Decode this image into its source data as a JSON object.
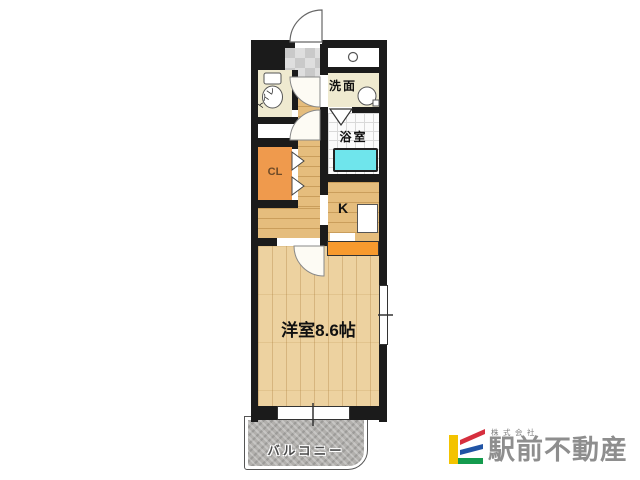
{
  "floorplan": {
    "labels": {
      "toilet": "トイレ",
      "washroom": "洗面",
      "bathroom": "浴室",
      "closet": "CL",
      "kitchen": "K",
      "main_room": "洋室8.6帖",
      "balcony": "バルコニー"
    },
    "colors": {
      "wall": "#1b1b1b",
      "hall_floor": "#e5bd7d",
      "room_floor": "#edd2a0",
      "cream_floor": "#efead0",
      "genkan_tile": "#d3d3d3",
      "closet_orange": "#ef9a4d",
      "counter_orange": "#f79a2e",
      "bathtub_cyan": "#6fe5ec",
      "balcony_gray": "#b2b0ad"
    }
  },
  "logo": {
    "prefix": "株式会社",
    "name": "駅前不動産",
    "colors": {
      "bar_yellow": "#f3c300",
      "stripe_red": "#d62f3e",
      "stripe_blue": "#2154a5",
      "stripe_green": "#149b4e",
      "text_gray": "#8e8e8e"
    }
  }
}
